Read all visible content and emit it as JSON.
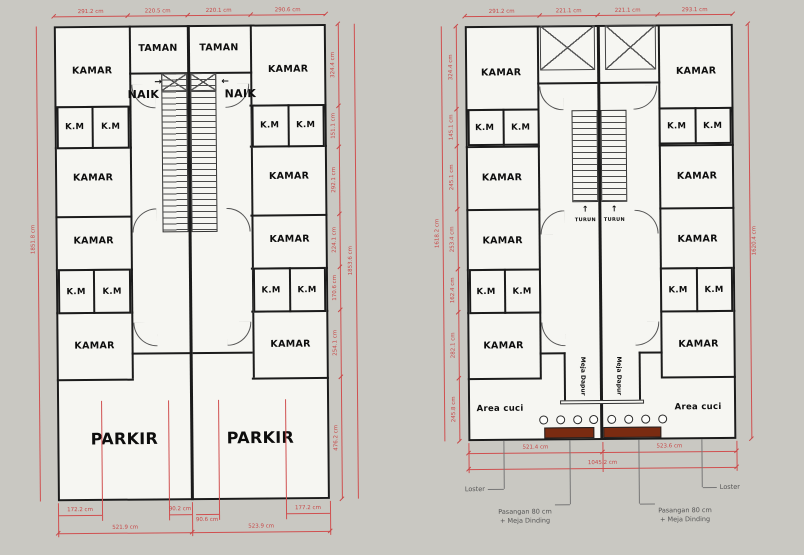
{
  "colors": {
    "background": "#c9c8c2",
    "floor_fill": "#f6f6f2",
    "wall": "#1b1b1b",
    "dimension": "#c84848",
    "counter_brown": "#7a2b11"
  },
  "labels": {
    "kamar": "KAMAR",
    "km": "K.M",
    "taman": "TAMAN",
    "naik": "NAIK",
    "parkir": "PARKIR",
    "turun": "TURUN",
    "meja_dapur": "Meja Dapur",
    "area_cuci": "Area cuci",
    "loster": "Loster",
    "pasangan_line1": "Pasangan 80 cm",
    "pasangan_line2": "+ Meja Dinding",
    "arrow_right": "→",
    "arrow_left": "←",
    "arrow_up": "↑"
  },
  "floor1": {
    "top_dims": [
      "291.2 cm",
      "220.5 cm",
      "220.1 cm",
      "290.6 cm"
    ],
    "left_total": "1851.8 cm",
    "right_segments": [
      "324.4 cm",
      "151.1 cm",
      "292.1 cm",
      "224.1 cm",
      "170.6 cm",
      "254.1 cm",
      "476.2 cm"
    ],
    "right_total": "1853.6 cm",
    "bottom_small": [
      "172.2 cm",
      "90.2 cm",
      "90.6 cm",
      "177.2 cm"
    ],
    "bottom_halves": [
      "521.9 cm",
      "523.9 cm"
    ]
  },
  "floor2": {
    "top_dims": [
      "291.2 cm",
      "221.1 cm",
      "221.1 cm",
      "293.1 cm"
    ],
    "left_segments": [
      "324.4 cm",
      "145.1 cm",
      "245.1 cm",
      "253.4 cm",
      "162.4 cm",
      "282.1 cm",
      "245.8 cm"
    ],
    "left_total": "1618.2 cm",
    "right_total": "1620.4 cm",
    "bottom_halves": [
      "521.4 cm",
      "523.6 cm"
    ],
    "bottom_total": "1045.2 cm"
  }
}
